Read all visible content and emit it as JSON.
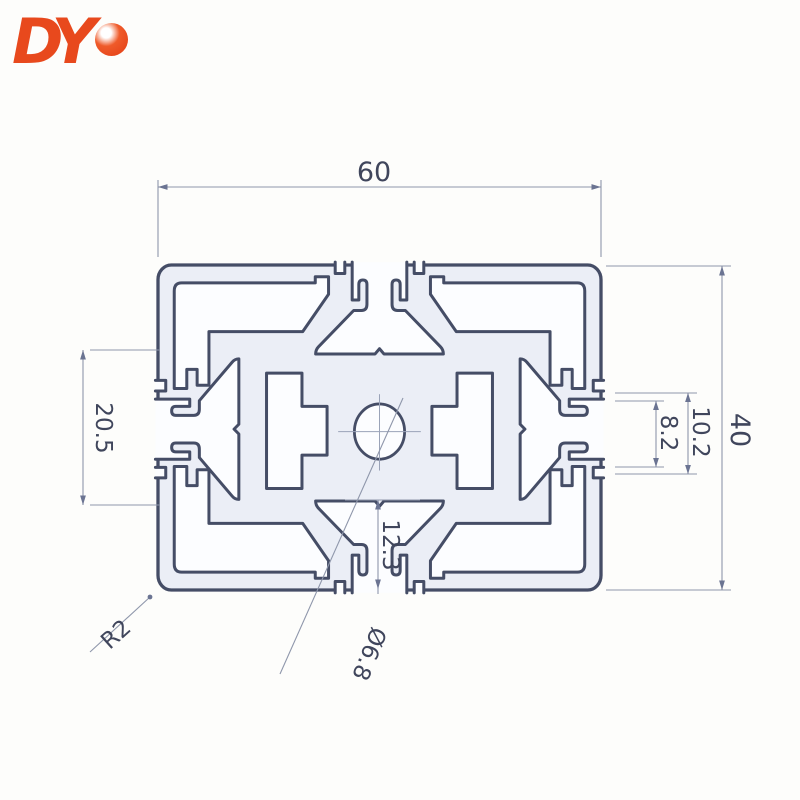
{
  "logo": {
    "text": "DY",
    "color": "#e8491d"
  },
  "drawing": {
    "title_implied": "aluminium profile cross-section",
    "dimensions": {
      "overall_width": "60",
      "overall_height": "40",
      "left_slot_span": "20.5",
      "slot_mouth_outer": "10.2",
      "slot_mouth_inner": "8.2",
      "bottom_slot_depth": "12.3",
      "corner_radius": "R2",
      "center_hole_diameter": "Ø6.8"
    },
    "colors": {
      "outline": "#454d66",
      "metal_fill": "#ebeef6",
      "cavity_fill": "#fcfdff",
      "dim_line": "#8f97ab",
      "dim_text": "#40465c",
      "logo": "#e8491d",
      "background": "#fdfdfb"
    }
  }
}
